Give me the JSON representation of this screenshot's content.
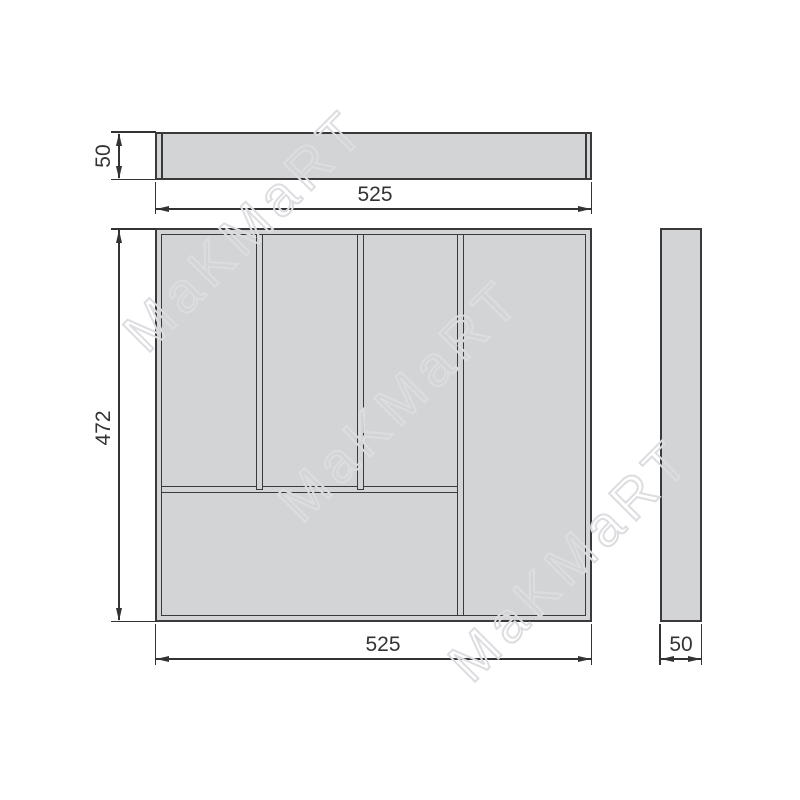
{
  "drawing": {
    "watermark_text": "MaKMaRT",
    "dims": {
      "front_height": "50",
      "front_width": "525",
      "plan_height": "472",
      "plan_width": "525",
      "side_width": "50"
    },
    "colors": {
      "fill": "#d3d4d6",
      "line": "#3a3a3c",
      "dim": "#333335",
      "wm": "#dcdde0",
      "bg": "#ffffff"
    }
  }
}
